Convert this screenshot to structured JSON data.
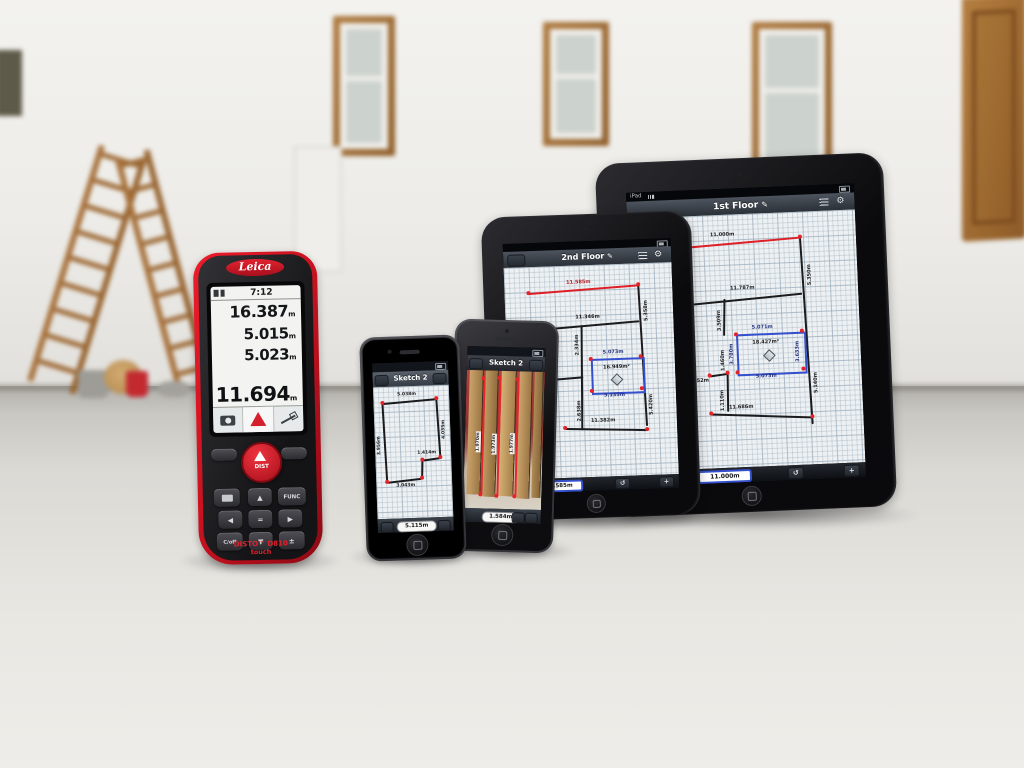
{
  "scene": {
    "description": "Leica DISTO D810 touch laser meter standing on the floor of an empty room beside two iPhones and two iPads running DISTO sketch apps; wooden stepladder and paint buckets in the blurred background"
  },
  "disto": {
    "brand": "Leica",
    "status_time": "7:12",
    "value1": "16.387",
    "value2": "5.015",
    "value3": "5.023",
    "unit": "m",
    "result": "11.694",
    "dist_key": "DIST",
    "func_key": "FUNC",
    "up_key": "▲",
    "down_key": "▼",
    "left_key": "◀",
    "right_key": "▶",
    "equals_key": "=",
    "clear_key": "C/off",
    "plusminus_key": "±",
    "model": "DISTO™ D810",
    "model_sub": "touch"
  },
  "iphone_sketch": {
    "title": "Sketch 2",
    "dim_top": "5.038m",
    "dim_right": "4.035m",
    "dim_left": "3.956m",
    "dim_step": "1.414m",
    "dim_bottom": "3.043m",
    "result_pill": "5.115m"
  },
  "iphone_photo": {
    "title": "Sketch 2",
    "dim1": "1.970m",
    "dim2": "1.973m",
    "dim3": "1.977m",
    "result_pill": "1.584m"
  },
  "ipad_mini": {
    "title": "2nd Floor",
    "edit_icon": "✎",
    "dim_top": "11.585m",
    "dim_h2": "11.346m",
    "dim_left_h": "5.324m",
    "dim_bottom_h": "11.382m",
    "dim_right_top": "5.358m",
    "dim_right_bottom": "5.420m",
    "dim_mid_top": "2.334m",
    "dim_mid_bottom": "2.638m",
    "dim_left_v": "1.459m",
    "blue_top": "5.073m",
    "blue_bottom": "5.135m",
    "area": "16.949m²",
    "result_pill": "11.585m",
    "plus_button": "+"
  },
  "ipad_large": {
    "status_left": "iPad",
    "title": "1st Floor",
    "edit_icon": "✎",
    "dim_top": "11.000m",
    "dim_h2": "11.787m",
    "dim_left_h": "5.354m",
    "dim_left_v": "6.055m",
    "dim_v2": "3.509m",
    "dim_bottom_h": "11.686m",
    "dim_right_top": "5.350m",
    "dim_right_bottom": "5.140m",
    "blue_top": "5.071m",
    "blue_bottom": "5.073m",
    "blue_left": "3.780m",
    "blue_right": "3.633m",
    "area": "18.427m²",
    "small1": "1.252m",
    "small2": "1.460m",
    "small3": "1.110m",
    "result_pill": "11.000m",
    "plus_button": "+"
  }
}
